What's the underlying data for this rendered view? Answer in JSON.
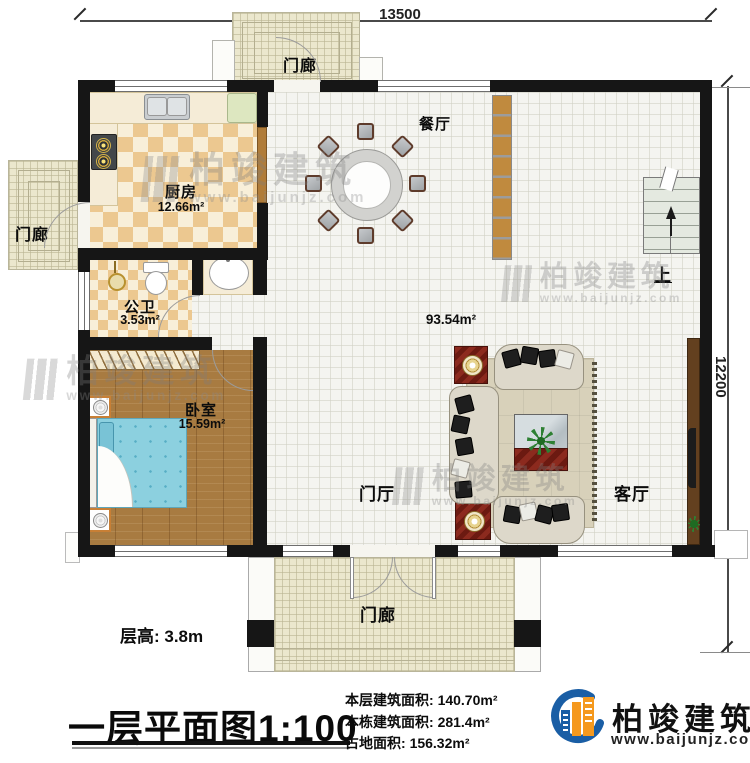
{
  "dimensions": {
    "width_top": "13500",
    "height_right": "12200"
  },
  "labels": {
    "kitchen": "厨房",
    "kitchen_area": "12.66m²",
    "bath": "公卫",
    "bath_area": "3.53m²",
    "bedroom": "卧室",
    "bedroom_area": "15.59m²",
    "dining": "餐厅",
    "hall_area": "93.54m²",
    "foyer": "门厅",
    "living": "客厅",
    "porch": "门廊",
    "stairs_up": "上",
    "floor_height": "层高: 3.8m"
  },
  "title": {
    "main": "一层平面图",
    "scale": "1:100"
  },
  "stats": [
    {
      "label": "本层建筑面积:",
      "value": "140.70m²"
    },
    {
      "label": "本栋建筑面积:",
      "value": "281.4m²"
    },
    {
      "label": "占地面积:",
      "value": "156.32m²"
    }
  ],
  "brand": {
    "name": "柏竣建筑",
    "site": "www.baijunjz.com"
  },
  "watermark": {
    "name": "柏竣建筑",
    "site": "www.baijunjz.com"
  }
}
